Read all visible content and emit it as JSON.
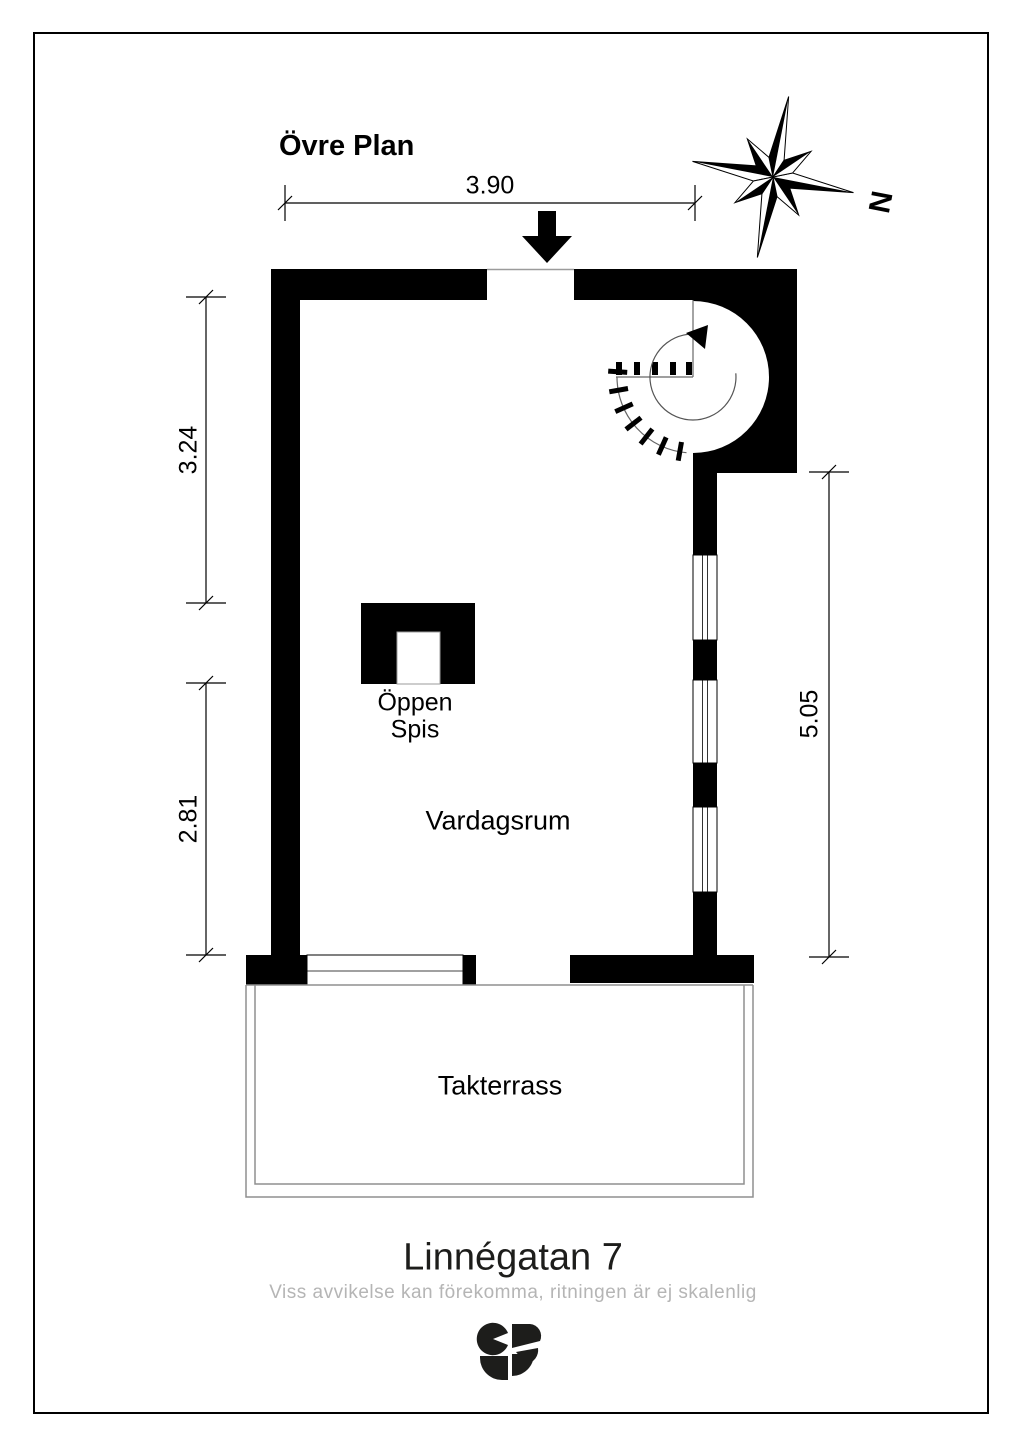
{
  "plan": {
    "floor_label": "Övre Plan",
    "address": "Linnégatan 7",
    "disclaimer": "Viss avvikelse kan förekomma, ritningen är ej skalenlig"
  },
  "compass": {
    "north_label": "N"
  },
  "rooms": {
    "living_room": "Vardagsrum",
    "roof_terrace": "Takterrass"
  },
  "fireplace": {
    "line1": "Öppen",
    "line2": "Spis"
  },
  "dimensions": {
    "top_width": "3.90",
    "left_upper": "3.24",
    "left_lower": "2.81",
    "right_height": "5.05"
  },
  "colors": {
    "wall": "#000000",
    "thin_line": "#9b9b9b",
    "disclaimer_text": "#b5b5b5",
    "logo": "#1d1d1b"
  }
}
